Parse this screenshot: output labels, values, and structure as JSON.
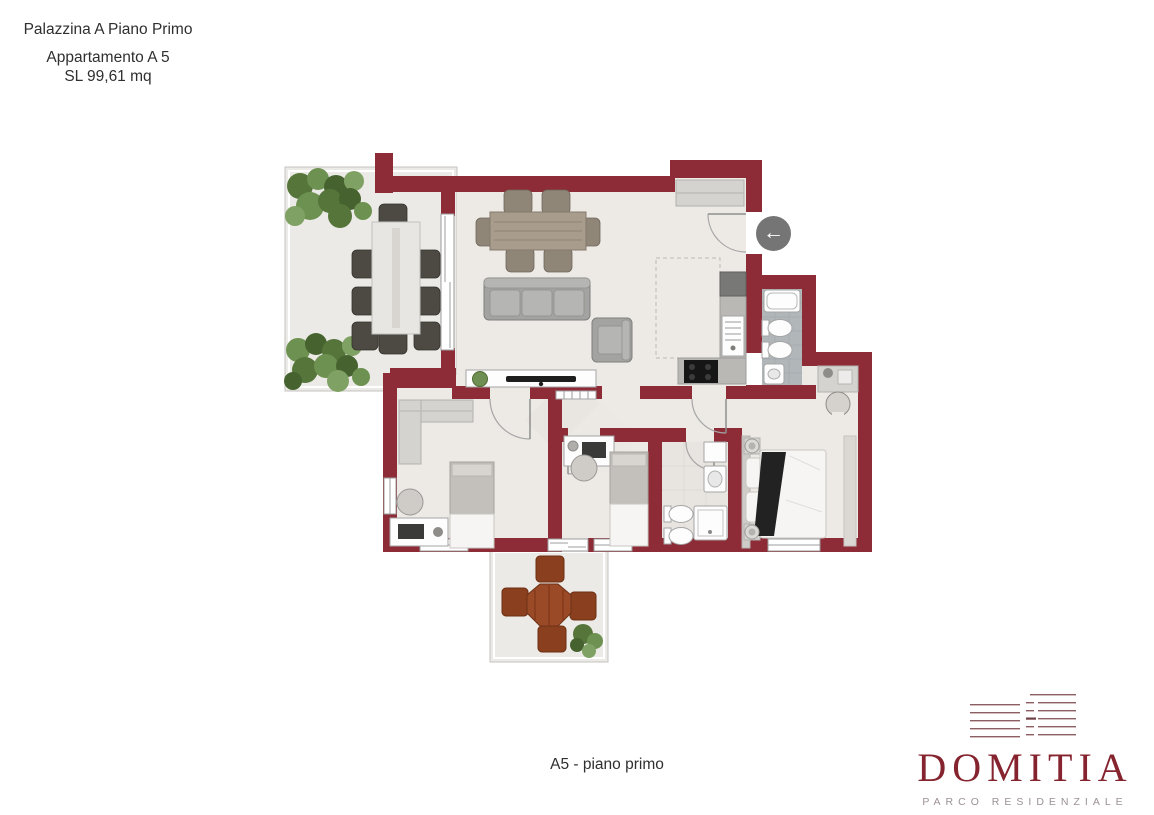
{
  "header": {
    "building": "Palazzina A Piano Primo",
    "apartment": "Appartamento A 5",
    "area": "SL 99,61 mq"
  },
  "caption": "A5 - piano primo",
  "brand": {
    "name": "DOMITIA",
    "tagline": "PARCO RESIDENZIALE"
  },
  "entrance": {
    "icon": "left-arrow-icon",
    "glyph": "←"
  },
  "colors": {
    "wall": "#8d2c36",
    "brand_red": "#85242f",
    "text": "#3a3a3a",
    "floor": "#edeae6",
    "bath_tile": "#b1b6b9",
    "arrow_background": "#757575"
  }
}
